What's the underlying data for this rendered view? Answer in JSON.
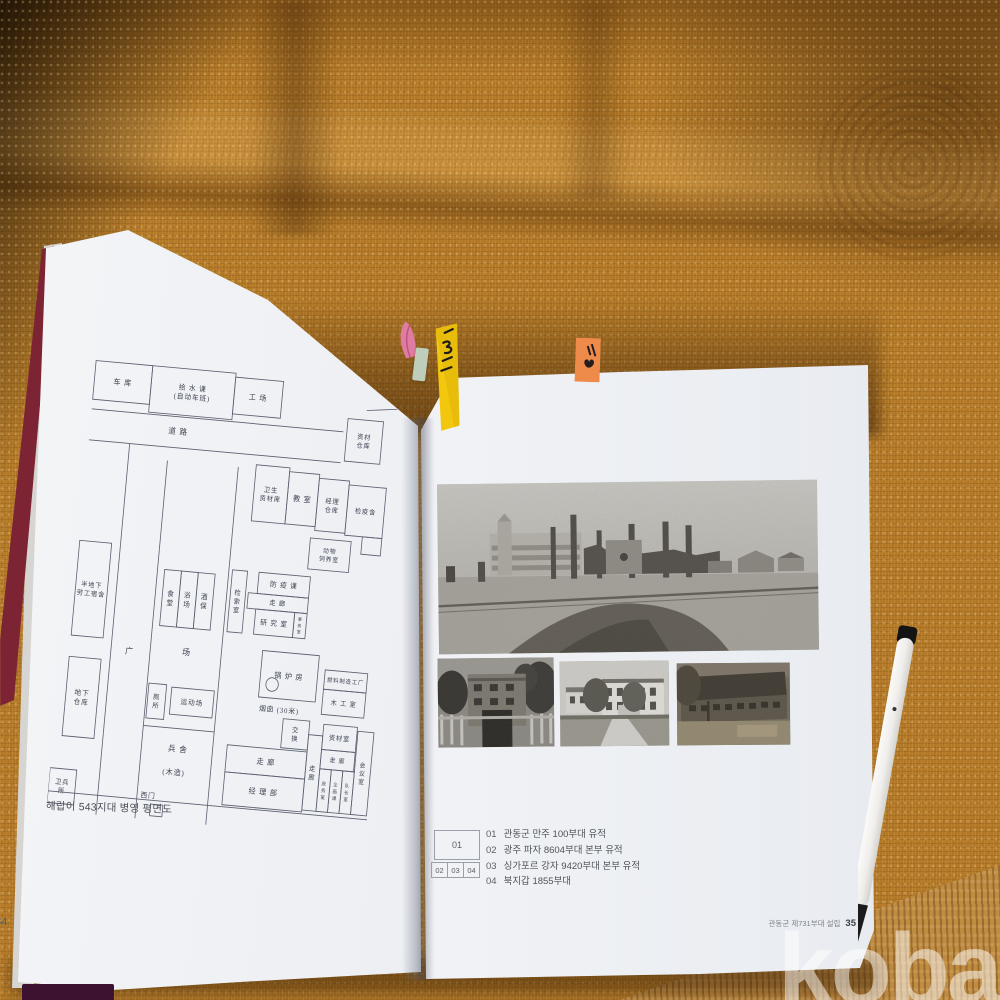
{
  "watermark": "kobay",
  "book": {
    "left_page": {
      "page_number": "34",
      "caption": "해랍이 543지대 병영 평면도",
      "floor_plan": {
        "chimney_circle": [
          240,
          324,
          7
        ],
        "rooms": [
          {
            "label": "车 库",
            "x": 10,
            "y": 8,
            "w": 64,
            "h": 40
          },
          {
            "label": "给 水 课\n(自动车班)",
            "x": 74,
            "y": 8,
            "w": 94,
            "h": 48,
            "fs": 7.5
          },
          {
            "label": "工 场",
            "x": 168,
            "y": 12,
            "w": 54,
            "h": 38
          },
          {
            "label": "资材\n仓库",
            "x": 298,
            "y": 44,
            "w": 40,
            "h": 44,
            "fs": 7
          },
          {
            "label": "卫生\n资材库",
            "x": 200,
            "y": 100,
            "w": 38,
            "h": 58,
            "fs": 7
          },
          {
            "label": "教 室",
            "x": 238,
            "y": 104,
            "w": 34,
            "h": 54
          },
          {
            "label": "经理\n仓库",
            "x": 272,
            "y": 108,
            "w": 34,
            "h": 54,
            "fs": 7
          },
          {
            "label": "检疫舍",
            "x": 306,
            "y": 112,
            "w": 42,
            "h": 52,
            "fs": 7
          },
          {
            "label": "",
            "x": 326,
            "y": 164,
            "w": 22,
            "h": 18
          },
          {
            "label": "动物\n饲养室",
            "x": 268,
            "y": 170,
            "w": 46,
            "h": 32,
            "fs": 6.5
          },
          {
            "label": "半地下\n劳工宿舍",
            "x": 10,
            "y": 194,
            "w": 36,
            "h": 98,
            "fs": 7
          },
          {
            "label": "食\n堂",
            "x": 108,
            "y": 216,
            "w": 19,
            "h": 58,
            "fs": 7.5
          },
          {
            "label": "浴\n场",
            "x": 127,
            "y": 216,
            "w": 19,
            "h": 58,
            "fs": 7.5
          },
          {
            "label": "酒\n保",
            "x": 146,
            "y": 216,
            "w": 19,
            "h": 58,
            "fs": 7.5
          },
          {
            "label": "检\n索\n室",
            "x": 184,
            "y": 210,
            "w": 17,
            "h": 64,
            "fs": 7
          },
          {
            "label": "防 疫 课",
            "x": 214,
            "y": 210,
            "w": 58,
            "h": 22,
            "fs": 7.5
          },
          {
            "label": "走 廊",
            "x": 204,
            "y": 232,
            "w": 68,
            "h": 16,
            "fs": 7
          },
          {
            "label": "研 究 室",
            "x": 214,
            "y": 248,
            "w": 44,
            "h": 26,
            "fs": 7.5
          },
          {
            "label": "事\n务\n室",
            "x": 258,
            "y": 248,
            "w": 14,
            "h": 26,
            "fs": 4.5
          },
          {
            "label": "锅 炉 房",
            "x": 226,
            "y": 290,
            "w": 64,
            "h": 48
          },
          {
            "label": "燃料制造工厂",
            "x": 298,
            "y": 304,
            "w": 48,
            "h": 20,
            "fs": 6
          },
          {
            "label": "木 工 室",
            "x": 298,
            "y": 324,
            "w": 48,
            "h": 26,
            "fs": 7
          },
          {
            "label": "地下\n仓库",
            "x": 10,
            "y": 314,
            "w": 36,
            "h": 82,
            "fs": 7.5
          },
          {
            "label": "厕\n所",
            "x": 102,
            "y": 334,
            "w": 20,
            "h": 36,
            "fs": 7
          },
          {
            "label": "运动场",
            "x": 128,
            "y": 336,
            "w": 48,
            "h": 28,
            "fs": 7.5
          },
          {
            "label": "交\n换",
            "x": 256,
            "y": 358,
            "w": 30,
            "h": 30,
            "fs": 7
          },
          {
            "label": "走 廊",
            "x": 196,
            "y": 390,
            "w": 90,
            "h": 28
          },
          {
            "label": "经 理 部",
            "x": 196,
            "y": 418,
            "w": 90,
            "h": 34
          },
          {
            "label": "走\n廊",
            "x": 286,
            "y": 372,
            "w": 16,
            "h": 78,
            "fs": 7
          },
          {
            "label": "资材室",
            "x": 302,
            "y": 360,
            "w": 38,
            "h": 26,
            "fs": 7
          },
          {
            "label": "走 廊",
            "x": 302,
            "y": 386,
            "w": 38,
            "h": 20,
            "fs": 6.5
          },
          {
            "label": "庶\n务\n室",
            "x": 302,
            "y": 406,
            "w": 13,
            "h": 44,
            "fs": 5
          },
          {
            "label": "企\n画\n课",
            "x": 315,
            "y": 406,
            "w": 13,
            "h": 44,
            "fs": 5
          },
          {
            "label": "队\n长\n室",
            "x": 328,
            "y": 406,
            "w": 13,
            "h": 44,
            "fs": 5
          },
          {
            "label": "会\n议\n室",
            "x": 341,
            "y": 364,
            "w": 18,
            "h": 86,
            "fs": 6.5
          },
          {
            "label": "卫兵\n所",
            "x": 0,
            "y": 430,
            "w": 30,
            "h": 36,
            "fs": 7
          }
        ],
        "free_labels": [
          {
            "text": "道 路",
            "x": 98,
            "y": 76,
            "fs": 8.5
          },
          {
            "text": "广",
            "x": 72,
            "y": 306,
            "fs": 9
          },
          {
            "text": "场",
            "x": 136,
            "y": 302,
            "fs": 9
          },
          {
            "text": "烟囱 (30米)",
            "x": 228,
            "y": 352,
            "fs": 7.5
          },
          {
            "text": "兵 舍",
            "x": 130,
            "y": 402,
            "fs": 8.5
          },
          {
            "text": "(木造)",
            "x": 126,
            "y": 426,
            "fs": 8
          },
          {
            "text": "西门",
            "x": 104,
            "y": 452,
            "fs": 7.5
          }
        ],
        "lines": [
          [
            10,
            58,
            294,
            58
          ],
          [
            10,
            90,
            294,
            90
          ],
          [
            56,
            90,
            56,
            474
          ],
          [
            100,
            104,
            100,
            474
          ],
          [
            180,
            104,
            180,
            474
          ],
          [
            100,
            378,
            180,
            378
          ],
          [
            0,
            454,
            360,
            454
          ],
          [
            116,
            458,
            116,
            470
          ],
          [
            130,
            458,
            130,
            470
          ],
          [
            116,
            470,
            130,
            470
          ],
          [
            116,
            458,
            130,
            458
          ],
          [
            318,
            34,
            352,
            30
          ]
        ]
      }
    },
    "right_page": {
      "page_number": "35",
      "running_footer": "관동군 제731부대 설립",
      "photo_legend": {
        "large": "01",
        "small": [
          "02",
          "03",
          "04"
        ]
      },
      "photo_captions": [
        {
          "num": "01",
          "text": "관동군 만주 100부대 유적"
        },
        {
          "num": "02",
          "text": "광주 파자 8604부대 본부 유적"
        },
        {
          "num": "03",
          "text": "싱가포르 강자 9420부대 본부 유적"
        },
        {
          "num": "04",
          "text": "북지갑 1855부대"
        }
      ]
    }
  },
  "colors": {
    "fabric": "#b47a28",
    "page": "#eef0f4",
    "cover_stripe": "#7c2434",
    "tab_yellow": "#f3c70d",
    "tab_orange": "#ee8a4a",
    "tab_pink": "#e07ba2",
    "tab_mint": "#bfcdbb",
    "watermark": "rgba(255,255,255,0.5)"
  }
}
